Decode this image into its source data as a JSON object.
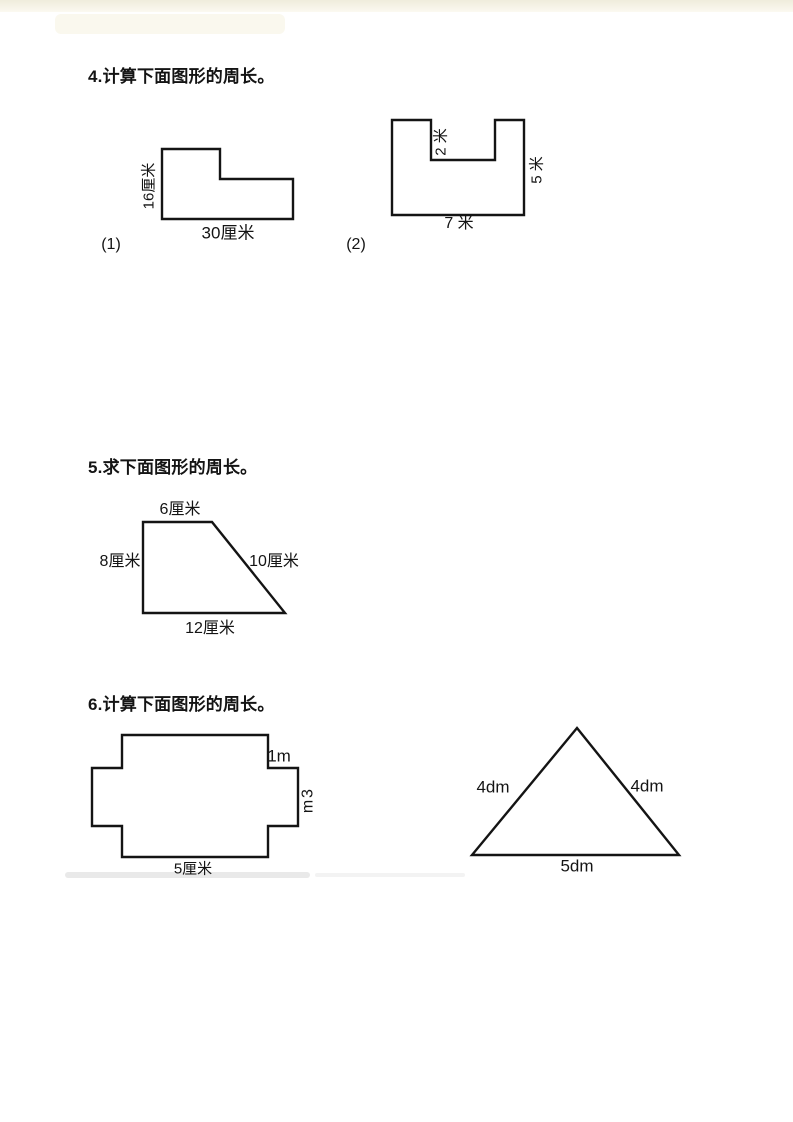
{
  "questions": [
    {
      "heading": "4.计算下面图形的周长。",
      "figures": [
        {
          "caption": "(1)",
          "shape": "l-shape",
          "labels": {
            "left": "16厘米",
            "bottom": "30厘米"
          }
        },
        {
          "caption": "(2)",
          "shape": "u-shape",
          "labels": {
            "notch": "2 米",
            "right": "5 米",
            "bottom": "7 米"
          }
        }
      ]
    },
    {
      "heading": "5.求下面图形的周长。",
      "figures": [
        {
          "shape": "trapezoid",
          "labels": {
            "top": "6厘米",
            "left": "8厘米",
            "right": "10厘米",
            "bottom": "12厘米"
          }
        }
      ]
    },
    {
      "heading": "6.计算下面图形的周长。",
      "figures": [
        {
          "shape": "cross",
          "labels": {
            "step": "1m",
            "bottom": "5厘米"
          },
          "right_chars": [
            "3",
            "m"
          ]
        },
        {
          "shape": "triangle",
          "labels": {
            "left": "4dm",
            "right": "4dm",
            "bottom": "5dm"
          }
        }
      ]
    }
  ]
}
